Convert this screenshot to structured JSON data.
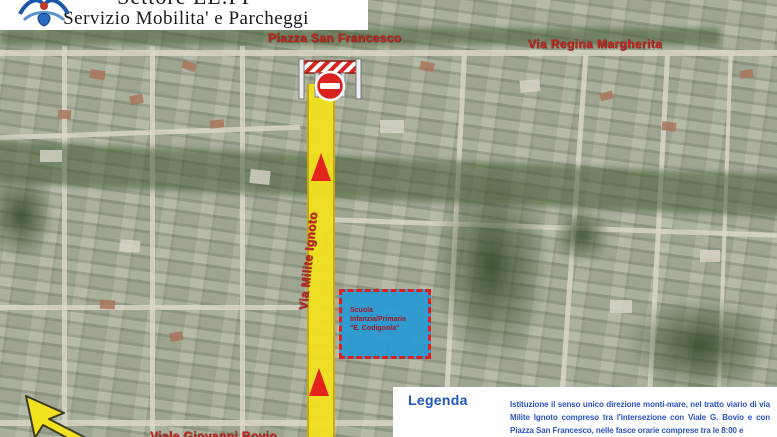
{
  "header": {
    "logo": "comune-crest",
    "title_line1": "Settore LL.PP",
    "title_line2": "Servizio Mobilita' e Parcheggi"
  },
  "map": {
    "labels": {
      "piazza_san_francesco": "Piazza San Francesco",
      "via_regina_margherita": "Via Regina Margherita",
      "via_milite_ignoto": "Via Milite Ignoto",
      "viale_giovanni_bovio": "Viale Giovanni Bovio"
    },
    "school_zone": {
      "line1": "Scuola",
      "line2": "Infanzia/Primaria",
      "line3": "\"E. Codignola\""
    },
    "route_highlight": {
      "street": "Via Milite Ignoto",
      "one_way_direction": "monti-mare",
      "direction_arrows": 2
    },
    "icons": {
      "no_entry_sign": "red-circle-white-bar",
      "road_barrier": "red-white-striped-barrier",
      "north_arrow": "yellow-arrow-up-left"
    }
  },
  "legend": {
    "title": "Legenda"
  },
  "note": {
    "text": "Istituzione il senso unico direzione monti-mare, nel tratto viario di via Milite Ignoto compreso tra l'intersezione con Viale G. Bovio e con Piazza San Francesco, nelle fasce orarie comprese tra le 8:00 e"
  },
  "colors": {
    "street_label": "#c42420",
    "route_yellow": "#f2e11f",
    "arrow_red": "#e3241d",
    "school_blue": "#2a9ad2",
    "legend_blue": "#1d55b8",
    "note_blue": "#2b52c4"
  }
}
